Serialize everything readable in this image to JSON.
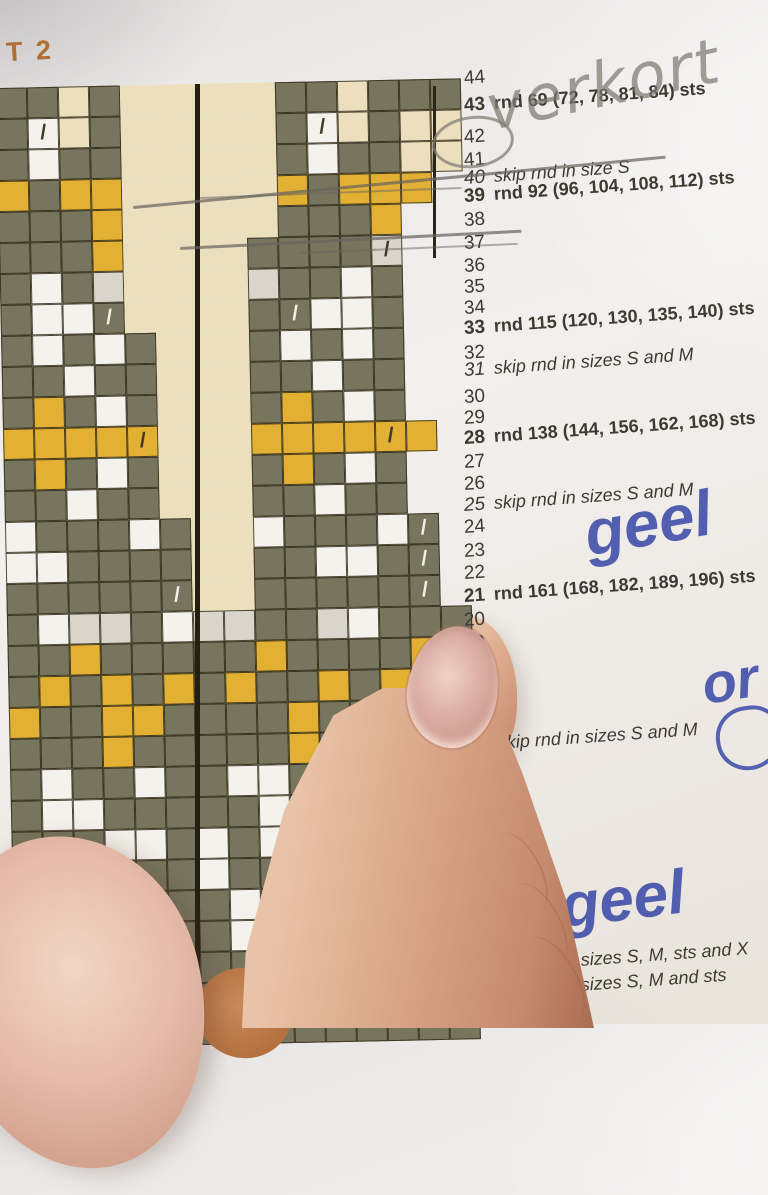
{
  "page": {
    "header": "T 2"
  },
  "chart": {
    "cell_size": 31,
    "origin_x": -6,
    "origin_y": 88,
    "colors": {
      "olive": "#77755e",
      "yellow": "#e2b133",
      "white": "#f4f2ec",
      "light_grey": "#d9d5cb",
      "cream": "#ebdfbe",
      "grid_line": "#302a18",
      "slash_dark": "#3d382a",
      "slash_light": "#f2efe6"
    },
    "legend": {
      "G": "olive stitch",
      "Y": "yellow stitch",
      "W": "white stitch",
      "L": "light grey stitch",
      "c": "cream stitch",
      "C": "cream no-stitch gutter",
      "g": "olive with light slash (decrease)",
      "w": "white with dark slash (decrease)",
      "l": "light grey with dark slash (decrease)",
      "y": "yellow with dark slash (decrease)",
      ".": "paper background"
    },
    "rows": [
      "GGcGCCCCCGGcGGG",
      "GwcGCCCCCGwcGcc",
      "GWGGCCCCCGWGGcc",
      "YGYYCCCCCYGYYY.",
      "GGGYCCCCCGGGY..",
      "GGGYCCCCGGGGl..",
      "GWGLCCCCLGGWG..",
      "GWWgCCCCGgWWG..",
      "GWGWGCCCGWGWG..",
      "GGWGGCCCGGWGG..",
      "GYGWGCCCGYGWG..",
      "YYYYyCCCYYYYyY.",
      "GYGWGCCCGYGWG..",
      "GGWGGCCCGGWGG..",
      "WGGGWGCCWGGGWg.",
      "WWGGGGCCGGWWGg.",
      "GGGGGgCCGGGGGg.",
      "GWLLGWLLGGLWGGG",
      "GGYGGGGGYGGGGYG",
      "GYGYGYGYGGYGYGY",
      "YGGYYGGGGYGGGGG",
      "GGGYGGGGGYGGGGG",
      "GWGGWGGWWGGWGGG",
      "GWWGGGGGWGWWGGG",
      "GGGWWGWGWGGGGGG",
      "GGGGGGWGGGGGGGG",
      "GGGGGGGWGGGGGGG",
      "GGGGGGGWWGGGGGG",
      "GGGGGGGGWGGGGGG",
      "GGGGGGGGGGGGGGG",
      "GGGGGGGGGGGGGGG"
    ]
  },
  "round_list": {
    "items": [
      {
        "num": "44",
        "y": 68
      },
      {
        "num": "43",
        "text": "rnd 69 (72, 78, 81, 84) sts",
        "bold": true,
        "y": 95
      },
      {
        "num": "42",
        "y": 127
      },
      {
        "num": "41",
        "y": 150
      },
      {
        "num": "40",
        "text": "skip rnd in size S",
        "italic": true,
        "y": 168
      },
      {
        "num": "39",
        "text": "rnd 92 (96, 104, 108, 112) sts",
        "bold": true,
        "y": 186
      },
      {
        "num": "38",
        "y": 210
      },
      {
        "num": "37",
        "y": 233
      },
      {
        "num": "36",
        "y": 256
      },
      {
        "num": "35",
        "y": 277
      },
      {
        "num": "34",
        "y": 298
      },
      {
        "num": "33",
        "text": "rnd 115 (120, 130, 135, 140) sts",
        "bold": true,
        "y": 318
      },
      {
        "num": "32",
        "y": 343
      },
      {
        "num": "31",
        "text": "skip rnd in sizes S and M",
        "italic": true,
        "y": 360
      },
      {
        "num": "30",
        "y": 387
      },
      {
        "num": "29",
        "y": 408
      },
      {
        "num": "28",
        "text": "rnd 138 (144, 156, 162, 168) sts",
        "bold": true,
        "y": 428
      },
      {
        "num": "27",
        "y": 452
      },
      {
        "num": "26",
        "y": 474
      },
      {
        "num": "25",
        "text": "skip rnd in sizes S and M",
        "italic": true,
        "y": 495
      },
      {
        "num": "24",
        "y": 517
      },
      {
        "num": "23",
        "y": 541
      },
      {
        "num": "22",
        "y": 563
      },
      {
        "num": "21",
        "text": "rnd 161 (168, 182, 189, 196) sts",
        "bold": true,
        "y": 586
      },
      {
        "num": "20",
        "y": 610
      },
      {
        "num": "19",
        "y": 633
      },
      {
        "num": "",
        "text": "skip rnd in sizes S and M",
        "italic": true,
        "y": 735,
        "x": 468
      },
      {
        "num": "",
        "text": ")",
        "bold": true,
        "y": 856,
        "x": 482
      },
      {
        "num": "8",
        "y": 905
      },
      {
        "num": "7",
        "y": 928
      },
      {
        "num": "6",
        "text": "skip rnd in sizes S, M, sts and X",
        "italic": true,
        "bold_num": true,
        "y": 958
      },
      {
        "num": "5",
        "text": "skip rnd in sizes S, M and sts",
        "italic": true,
        "bold_num": true,
        "y": 983
      },
      {
        "num": "4",
        "y": 1008
      }
    ]
  },
  "handwriting": {
    "pencil_word": "verkort",
    "pen_word_mid": "geel",
    "pen_word_bottom": "⇒ geel",
    "pen_right_edge": "or",
    "notes": "pencil circle around round 42, pencil strike-through lines over rounds 40 and 37"
  }
}
